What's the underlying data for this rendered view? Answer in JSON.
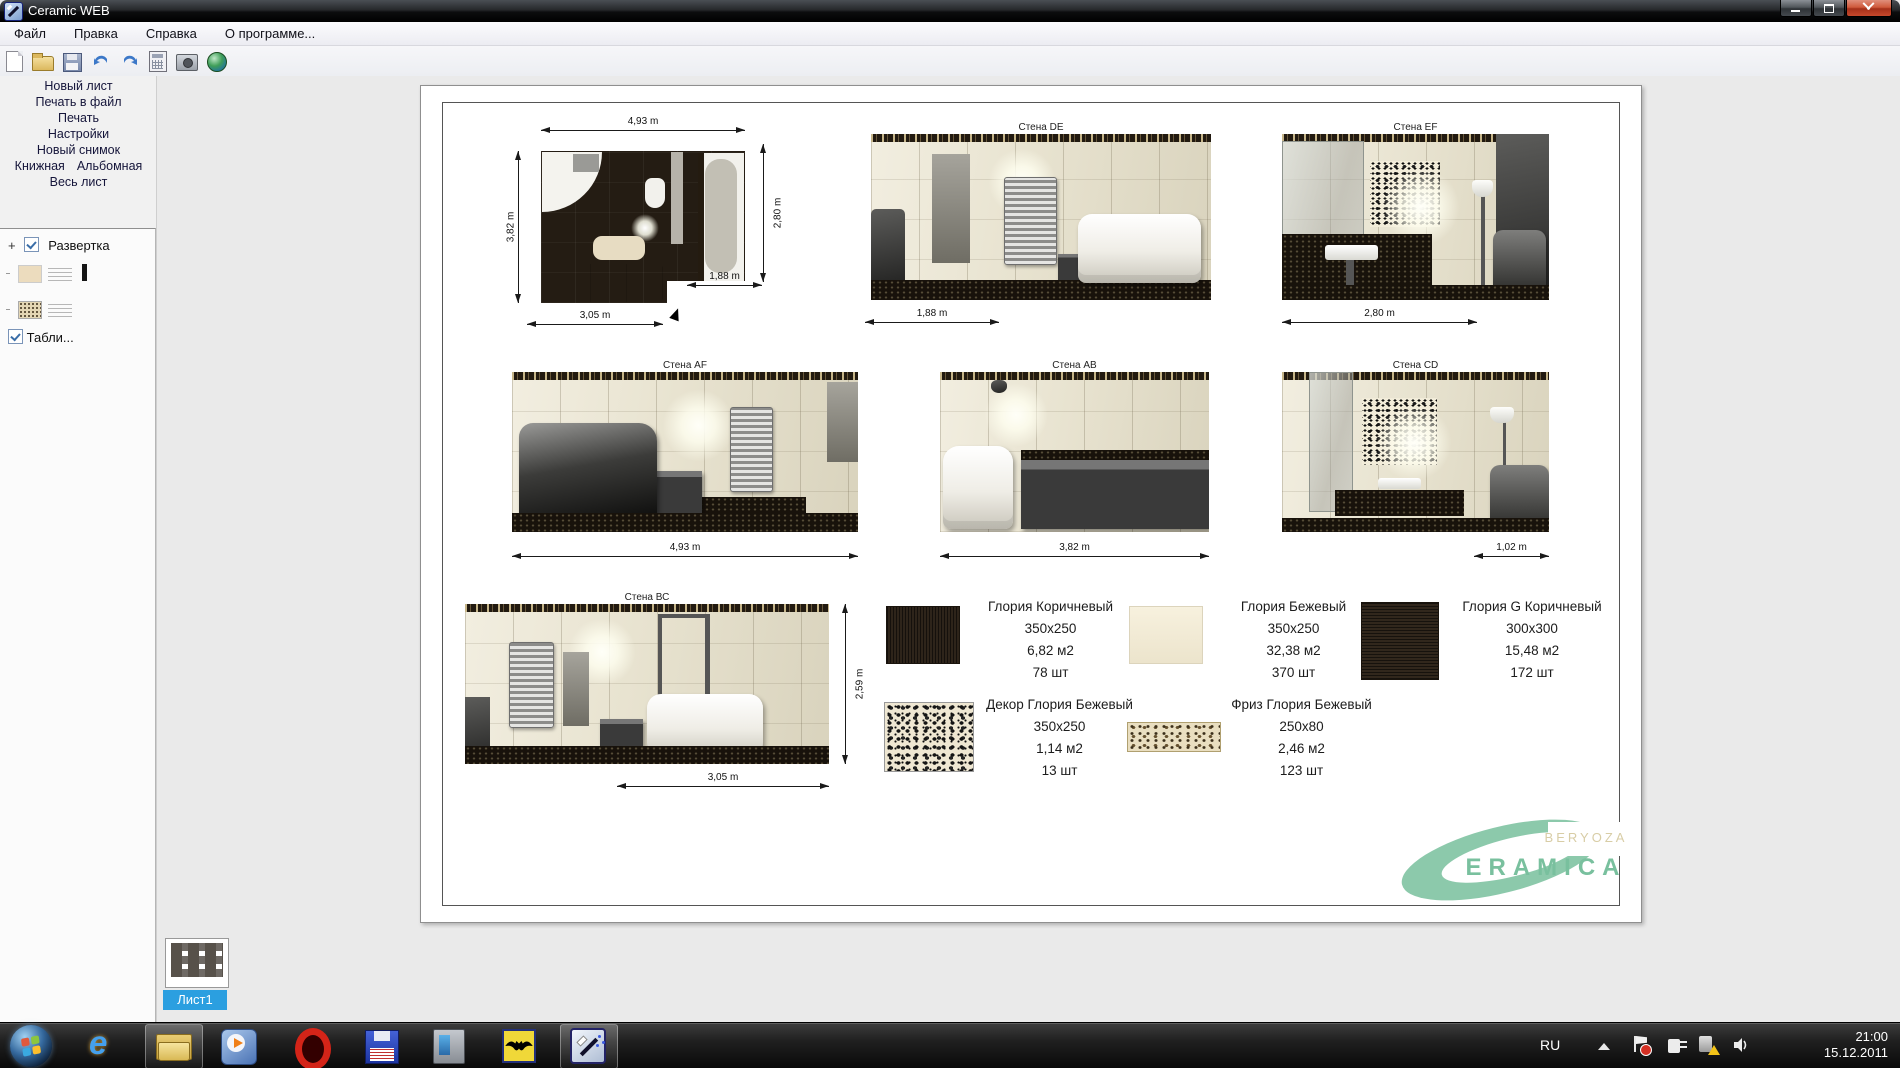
{
  "window": {
    "title": "Ceramic WEB"
  },
  "menu": {
    "items": [
      "Файл",
      "Правка",
      "Справка",
      "О программе..."
    ]
  },
  "toolbar": {
    "tabs": [
      "План помещения",
      "Укладка плитки",
      "Установка объектов",
      "Просмотр",
      "Печать"
    ],
    "active_tab": "Печать"
  },
  "sidebar": {
    "actions": [
      "Новый лист",
      "Печать в файл",
      "Печать",
      "Настройки",
      "Новый снимок"
    ],
    "orientation_portrait": "Книжная",
    "orientation_landscape": "Альбомная",
    "fit_label": "Весь лист",
    "tree_root": "Развертка",
    "table_label": "Табли..."
  },
  "page": {
    "plan": {
      "dims": {
        "top": "4,93 m",
        "left": "3,82 m",
        "right": "2,80 m",
        "inner": "1,88 m",
        "bottom": "3,05 m"
      }
    },
    "walls": [
      {
        "name": "Стена DE",
        "dim": "1,88 m"
      },
      {
        "name": "Стена EF",
        "dim": "2,80 m"
      },
      {
        "name": "Стена AF",
        "dim": "4,93 m"
      },
      {
        "name": "Стена АВ",
        "dim": "3,82 m"
      },
      {
        "name": "Стена CD",
        "dim": "1,02 m"
      },
      {
        "name": "Стена ВС",
        "dim": "3,05 m",
        "height_dim": "2,59 m"
      }
    ],
    "legend": [
      {
        "name": "Глория Коричневый",
        "size": "350x250",
        "area": "6,82 м2",
        "count": "78 шт"
      },
      {
        "name": "Глория Бежевый",
        "size": "350x250",
        "area": "32,38 м2",
        "count": "370 шт"
      },
      {
        "name": "Глория G Коричневый",
        "size": "300x300",
        "area": "15,48 м2",
        "count": "172 шт"
      },
      {
        "name": "Декор Глория Бежевый",
        "size": "350x250",
        "area": "1,14 м2",
        "count": "13 шт"
      },
      {
        "name": "Фриз Глория Бежевый",
        "size": "250x80",
        "area": "2,46 м2",
        "count": "123 шт"
      }
    ],
    "logo": {
      "line1": "BERYOZA",
      "line2": "ERAMICA"
    }
  },
  "sheet": {
    "tab": "Лист1"
  },
  "taskbar": {
    "lang": "RU",
    "time": "21:00",
    "date": "15.12.2011"
  },
  "colors": {
    "sheet_tab_blue": "#2b9fe0",
    "logo_green": "#8cc9ab",
    "logo_beige": "#d8cda6"
  }
}
